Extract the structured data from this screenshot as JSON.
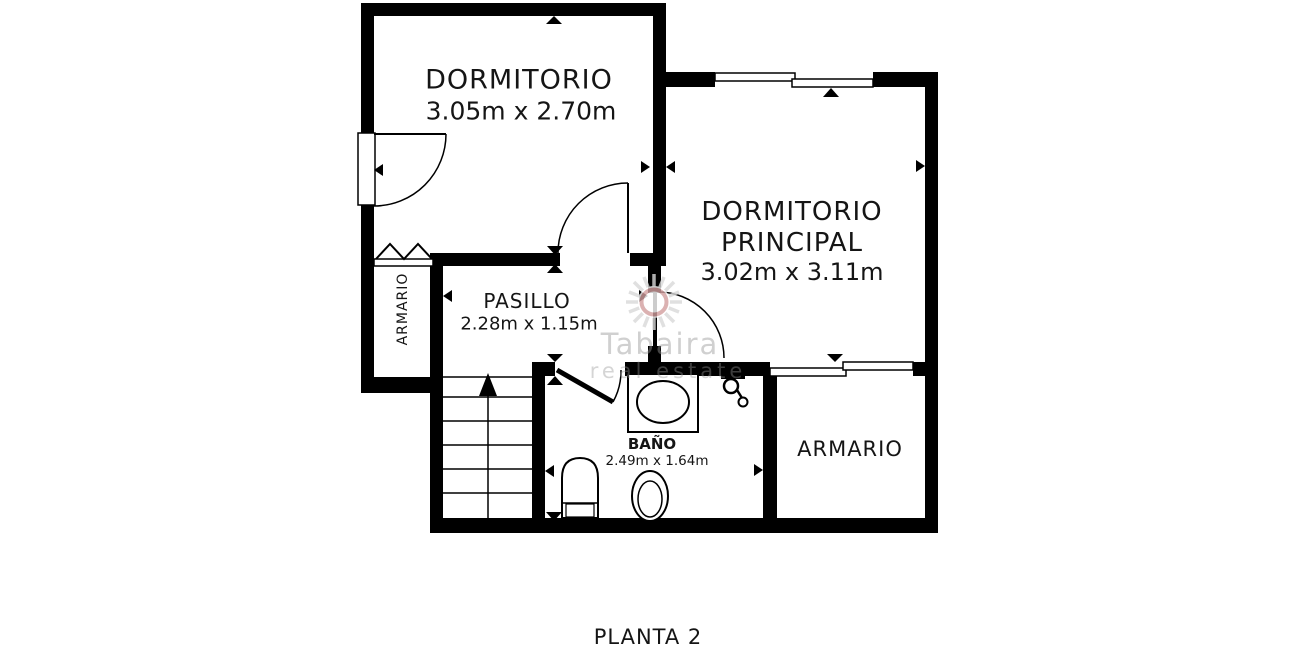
{
  "floor_plan": {
    "title": "PLANTA 2",
    "rooms": {
      "dormitorio": {
        "name": "DORMITORIO",
        "dimensions": "3.05m x 2.70m"
      },
      "dormitorio_principal": {
        "name_line1": "DORMITORIO",
        "name_line2": "PRINCIPAL",
        "dimensions": "3.02m x 3.11m"
      },
      "pasillo": {
        "name": "PASILLO",
        "dimensions": "2.28m x 1.15m"
      },
      "bano": {
        "name": "BAÑO",
        "dimensions": "2.49m x 1.64m"
      },
      "armario_left": {
        "name": "ARMARIO"
      },
      "armario_right": {
        "name": "ARMARIO"
      }
    },
    "fixtures_visible": [
      "stairs-up-arrow",
      "sink",
      "wall-tap",
      "water-heater",
      "toilet",
      "bifold-door",
      "sliding-window",
      "sliding-door",
      "swing-doors"
    ],
    "watermark": {
      "line1": "Tabaira",
      "line2": "real estate"
    },
    "colors": {
      "wall": "#000000",
      "text": "#151515",
      "background": "#ffffff",
      "watermark_gray": "#d9d9d9",
      "watermark_ring": "#c47e7e"
    }
  }
}
